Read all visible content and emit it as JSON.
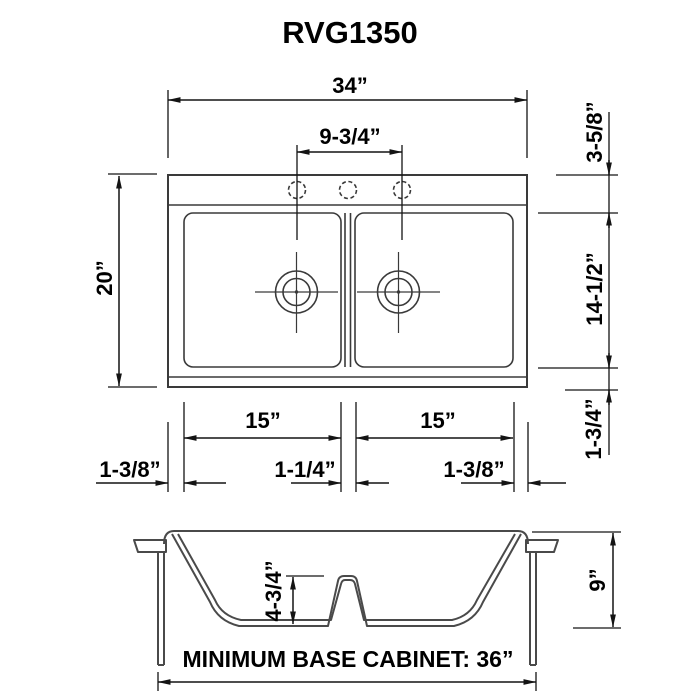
{
  "title": "RVG1350",
  "top_view": {
    "overall_width": "34”",
    "faucet_hole_spacing": "9-3/4”",
    "overall_depth": "20”",
    "rear_deck_depth": "3-5/8”",
    "bowl_front_to_back": "14-1/2”",
    "front_rim_depth": "1-3/4”",
    "left_bowl_width": "15”",
    "right_bowl_width": "15”",
    "left_rim_width": "1-3/8”",
    "divider_width": "1-1/4”",
    "right_rim_width": "1-3/8”"
  },
  "side_view": {
    "divider_height": "4-3/4”",
    "bowl_depth": "9”",
    "cabinet_note": "MINIMUM BASE CABINET: 36”"
  }
}
